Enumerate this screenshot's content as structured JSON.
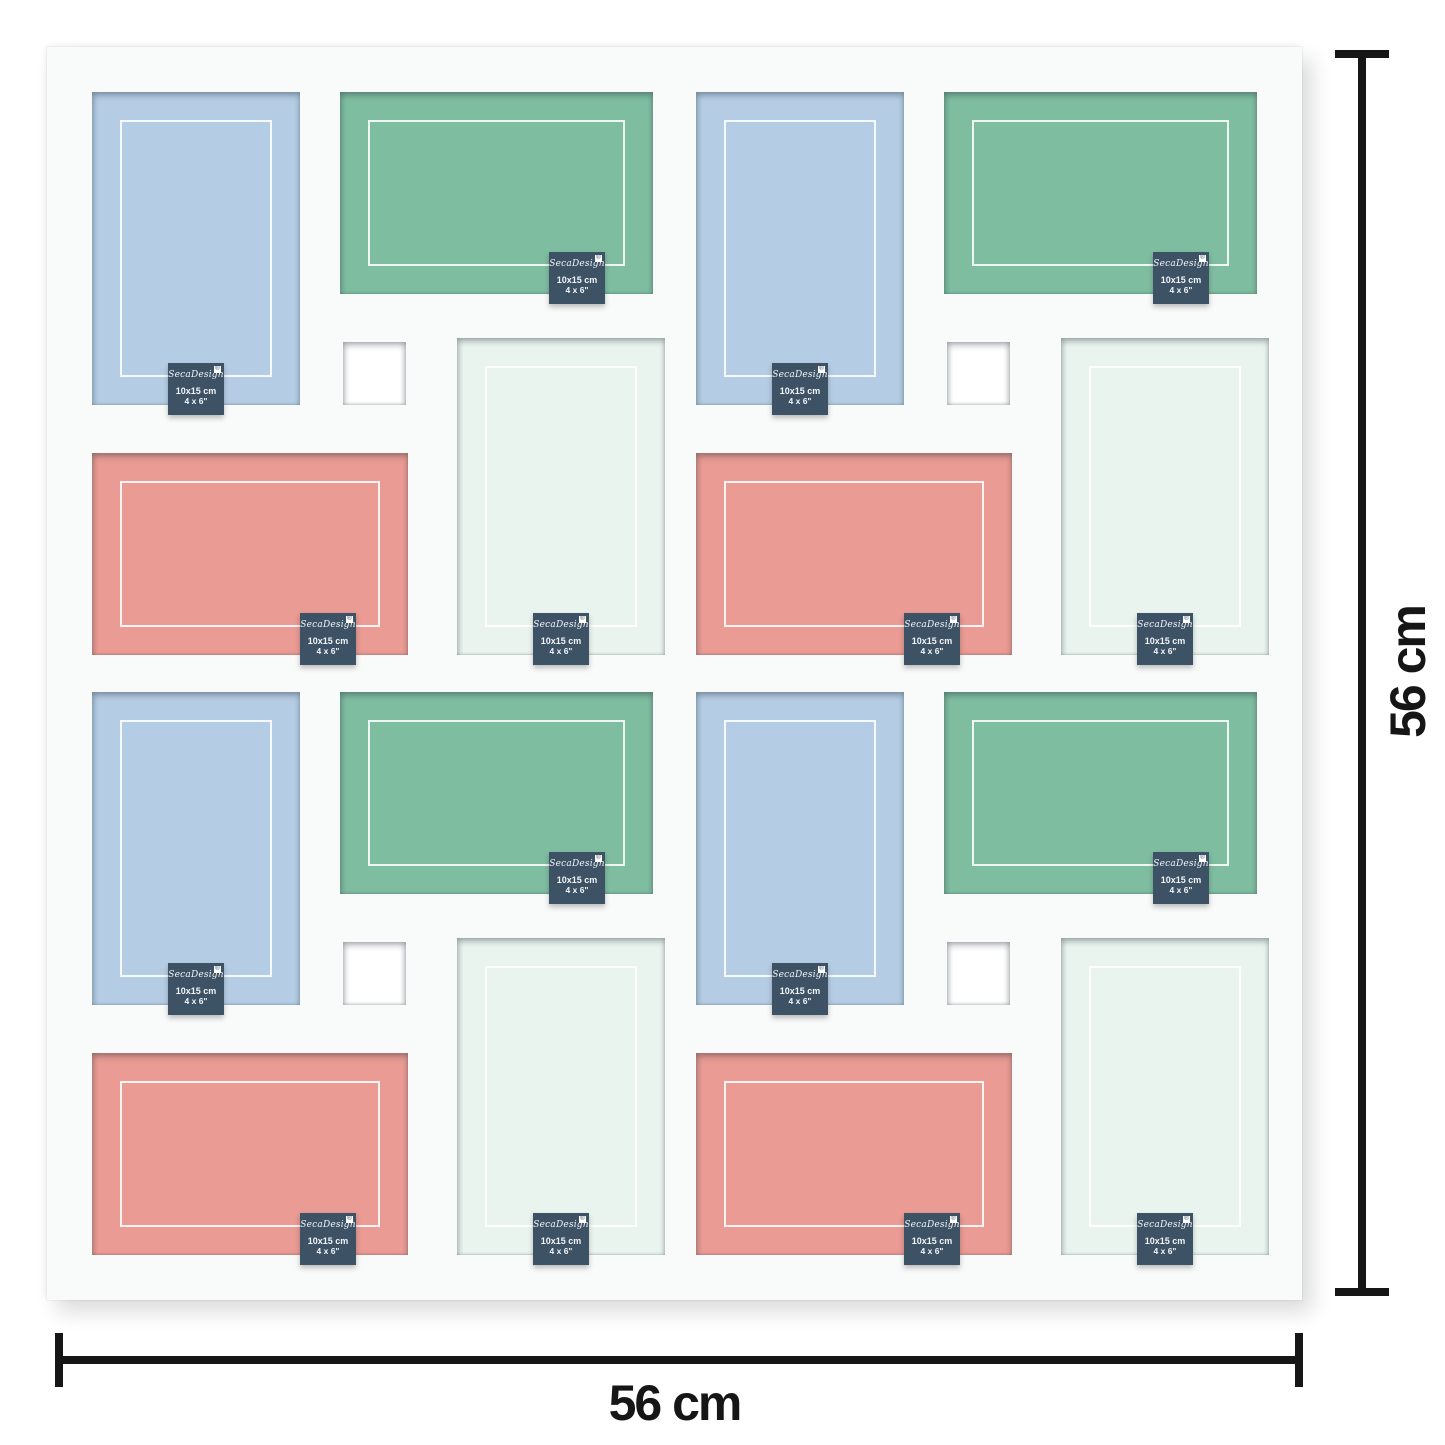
{
  "product": {
    "brand": "SecaDesign",
    "tag": {
      "brand": "SecaDesign",
      "registered_mark": "®",
      "size_cm": "10x15 cm",
      "size_inch": "4 x 6\""
    },
    "dimensions": {
      "width_label": "56 cm",
      "height_label": "56 cm"
    }
  },
  "colors": {
    "photo_blue": "#b5cde4",
    "photo_green": "#7fbda1",
    "photo_salmon": "#ea9b94",
    "photo_mint": "#eaf4ef",
    "square_hole": "#ffffff",
    "mat": "#f9fafa",
    "tag_background": "#3e5266",
    "tag_text": "#f2f5f8",
    "dimension_lines": "#161616"
  },
  "openings_pattern": {
    "per_quadrant": [
      "portrait-blue",
      "landscape-green",
      "small-square",
      "portrait-mint",
      "landscape-salmon"
    ],
    "quadrant_count": 4,
    "photo_opening_count": 16,
    "small_square_count": 4
  }
}
